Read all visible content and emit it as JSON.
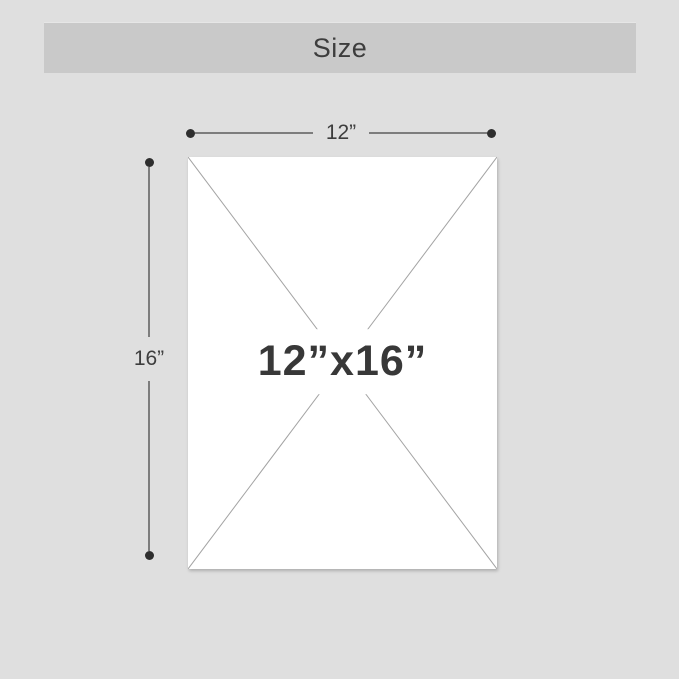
{
  "header": {
    "title": "Size"
  },
  "panel": {
    "size_label": "12”x16”",
    "background": "#ffffff",
    "diagonal_color": "#a3a3a3"
  },
  "dimensions": {
    "width": {
      "label": "12”"
    },
    "height": {
      "label": "16”"
    }
  },
  "colors": {
    "page_background": "#dfdfdf",
    "title_band": "#c9c9c9",
    "text": "#3d3d3d",
    "dimension_line": "#7d7d7d",
    "endpoint_dot": "#2e2e2e"
  }
}
